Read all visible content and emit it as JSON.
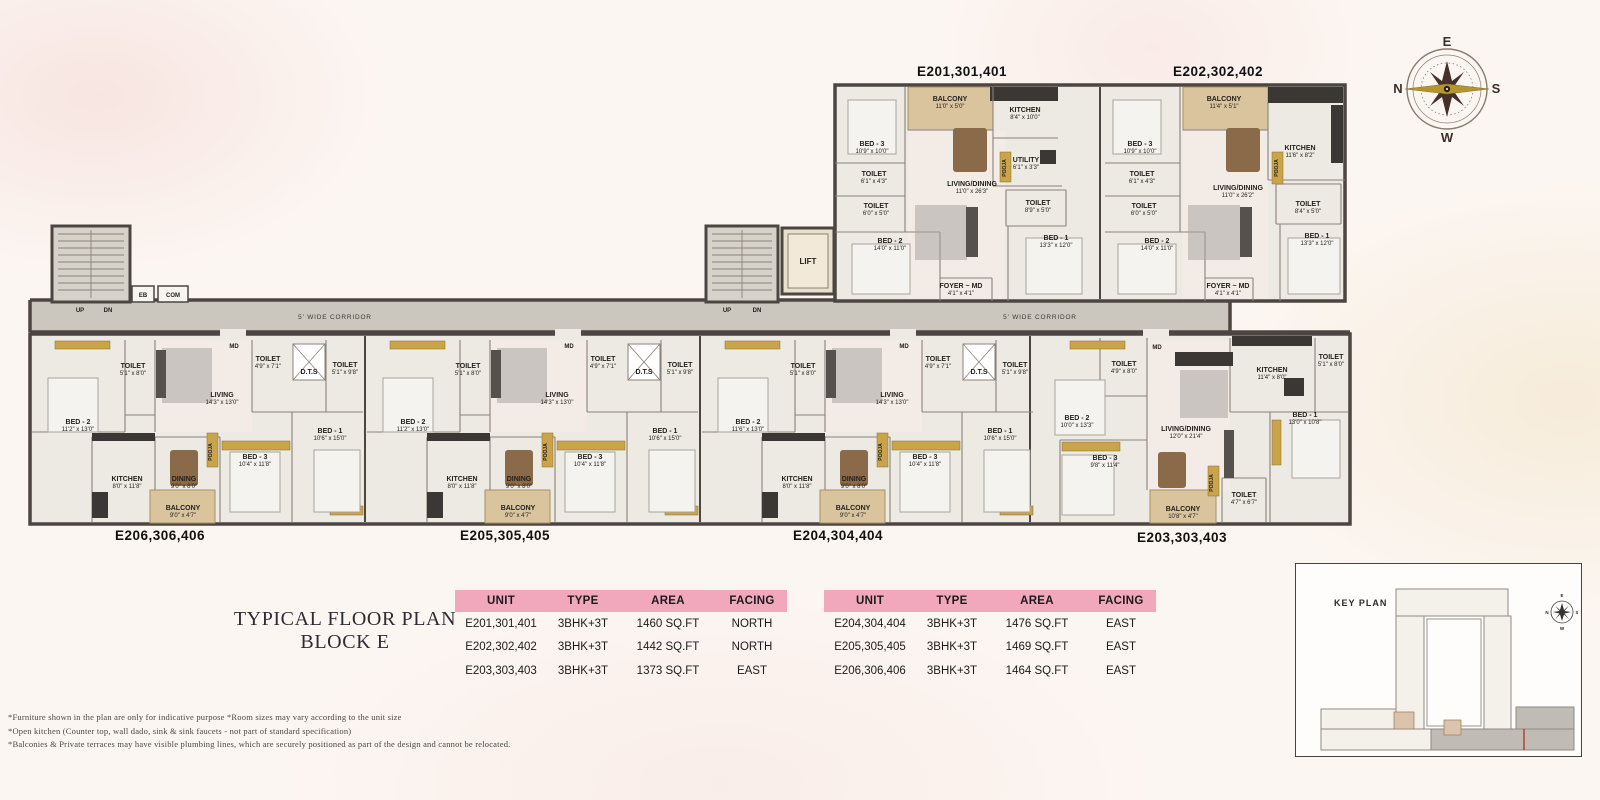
{
  "colors": {
    "header_pink": "#f2a8bc",
    "wall": "#4c4541",
    "partition": "#8a817a",
    "floor": "#edeae3",
    "living_tint": "#f3ece6",
    "balcony": "#d9c49e",
    "balcony_edge": "#a8925f",
    "corridor": "#cbc7be",
    "stair": "#d6d2c9",
    "dark_kitchen": "#3b3734",
    "gold": "#c9a44a",
    "bed": "#f4f3ef",
    "rug": "#a8a5a0"
  },
  "compass": {
    "top": "E",
    "right": "S",
    "bottom": "W",
    "left": "N"
  },
  "title": {
    "line1": "TYPICAL FLOOR PLAN",
    "line2": "BLOCK E"
  },
  "tables": [
    {
      "headers": [
        "UNIT",
        "TYPE",
        "AREA",
        "FACING"
      ],
      "rows": [
        [
          "E201,301,401",
          "3BHK+3T",
          "1460 SQ.FT",
          "NORTH"
        ],
        [
          "E202,302,402",
          "3BHK+3T",
          "1442 SQ.FT",
          "NORTH"
        ],
        [
          "E203,303,403",
          "3BHK+3T",
          "1373 SQ.FT",
          "EAST"
        ]
      ]
    },
    {
      "headers": [
        "UNIT",
        "TYPE",
        "AREA",
        "FACING"
      ],
      "rows": [
        [
          "E204,304,404",
          "3BHK+3T",
          "1476 SQ.FT",
          "EAST"
        ],
        [
          "E205,305,405",
          "3BHK+3T",
          "1469 SQ.FT",
          "EAST"
        ],
        [
          "E206,306,406",
          "3BHK+3T",
          "1464 SQ.FT",
          "EAST"
        ]
      ]
    }
  ],
  "footnotes": [
    "*Furniture shown in the plan are only for indicative purpose *Room sizes may vary according to the unit size",
    "*Open kitchen (Counter top, wall dado, sink & sink faucets - not part of standard  specification)",
    "*Balconies & Private terraces may have visible plumbing lines, which are securely positioned as part of the design and cannot  be  relocated."
  ],
  "keyplan": {
    "label": "KEY PLAN",
    "compass": {
      "top": "E",
      "right": "S",
      "bottom": "W",
      "left": "N"
    }
  },
  "plan": {
    "corridor_labels": [
      {
        "t": "5' WIDE CORRIDOR",
        "x": 335,
        "y": 319
      },
      {
        "t": "5' WIDE CORRIDOR",
        "x": 1040,
        "y": 319
      }
    ],
    "small_labels": [
      {
        "t": "UP",
        "x": 80,
        "y": 312
      },
      {
        "t": "DN",
        "x": 108,
        "y": 312
      },
      {
        "t": "UP",
        "x": 727,
        "y": 312
      },
      {
        "t": "DN",
        "x": 757,
        "y": 312
      },
      {
        "t": "EB",
        "x": 143,
        "y": 297
      },
      {
        "t": "COM",
        "x": 173,
        "y": 297
      },
      {
        "t": "LIFT",
        "x": 808,
        "y": 264,
        "s": 8
      },
      {
        "t": "MD",
        "x": 234,
        "y": 348
      },
      {
        "t": "MD",
        "x": 569,
        "y": 348
      },
      {
        "t": "MD",
        "x": 904,
        "y": 348
      },
      {
        "t": "MD",
        "x": 1157,
        "y": 349
      },
      {
        "t": "POOJA",
        "x": 212,
        "y": 452,
        "r": -90,
        "s": 5
      },
      {
        "t": "POOJA",
        "x": 547,
        "y": 452,
        "r": -90,
        "s": 5
      },
      {
        "t": "POOJA",
        "x": 882,
        "y": 452,
        "r": -90,
        "s": 5
      },
      {
        "t": "POOJA",
        "x": 1213,
        "y": 483,
        "r": -90,
        "s": 5
      },
      {
        "t": "POOJA",
        "x": 1006,
        "y": 168,
        "r": -90,
        "s": 5
      },
      {
        "t": "POOJA",
        "x": 1278,
        "y": 168,
        "r": -90,
        "s": 5
      }
    ],
    "units": [
      {
        "label": "E201,301,401",
        "lx": 962,
        "ly": 76,
        "rooms": [
          {
            "n": "BED - 3",
            "d": "10'9\" x 10'0\"",
            "x": 872,
            "y": 146
          },
          {
            "n": "BALCONY",
            "d": "11'0\" x 5'0\"",
            "x": 950,
            "y": 101
          },
          {
            "n": "KITCHEN",
            "d": "8'4\" x 10'0\"",
            "x": 1025,
            "y": 112
          },
          {
            "n": "UTILITY",
            "d": "6'1\" x 3'3\"",
            "x": 1026,
            "y": 162
          },
          {
            "n": "TOILET",
            "d": "6'1\" x 4'3\"",
            "x": 874,
            "y": 176
          },
          {
            "n": "TOILET",
            "d": "6'0\" x 5'0\"",
            "x": 876,
            "y": 208
          },
          {
            "n": "LIVING/DINING",
            "d": "11'0\" x 26'3\"",
            "x": 972,
            "y": 186
          },
          {
            "n": "TOILET",
            "d": "8'9\" x 5'0\"",
            "x": 1038,
            "y": 205
          },
          {
            "n": "BED - 2",
            "d": "14'0\" x 11'0\"",
            "x": 890,
            "y": 243
          },
          {
            "n": "BED - 1",
            "d": "13'3\" x 12'0\"",
            "x": 1056,
            "y": 240
          },
          {
            "n": "FOYER ~ MD",
            "d": "4'1\" x 4'1\"",
            "x": 961,
            "y": 288
          }
        ]
      },
      {
        "label": "E202,302,402",
        "lx": 1218,
        "ly": 76,
        "rooms": [
          {
            "n": "BED - 3",
            "d": "10'9\" x 10'0\"",
            "x": 1140,
            "y": 146
          },
          {
            "n": "BALCONY",
            "d": "11'4\" x 5'1\"",
            "x": 1224,
            "y": 101
          },
          {
            "n": "KITCHEN",
            "d": "11'6\" x 8'2\"",
            "x": 1300,
            "y": 150
          },
          {
            "n": "TOILET",
            "d": "6'1\" x 4'3\"",
            "x": 1142,
            "y": 176
          },
          {
            "n": "TOILET",
            "d": "6'0\" x 5'0\"",
            "x": 1144,
            "y": 208
          },
          {
            "n": "LIVING/DINING",
            "d": "11'0\" x 26'2\"",
            "x": 1238,
            "y": 190
          },
          {
            "n": "TOILET",
            "d": "8'4\" x 5'0\"",
            "x": 1308,
            "y": 206
          },
          {
            "n": "BED - 2",
            "d": "14'0\" x 11'0\"",
            "x": 1157,
            "y": 243
          },
          {
            "n": "BED - 1",
            "d": "13'3\" x 12'0\"",
            "x": 1317,
            "y": 238
          },
          {
            "n": "FOYER ~ MD",
            "d": "4'1\" x 4'1\"",
            "x": 1228,
            "y": 288
          }
        ]
      },
      {
        "label": "E206,306,406",
        "lx": 160,
        "ly": 540,
        "rooms": [
          {
            "n": "BED - 2",
            "d": "11'2\" x 13'0\"",
            "x": 78,
            "y": 424
          },
          {
            "n": "TOILET",
            "d": "5'1\" x 8'0\"",
            "x": 133,
            "y": 368
          },
          {
            "n": "LIVING",
            "d": "14'3\" x 13'0\"",
            "x": 222,
            "y": 397
          },
          {
            "n": "TOILET",
            "d": "4'9\" x 7'1\"",
            "x": 268,
            "y": 361
          },
          {
            "n": "D.T.S",
            "d": "",
            "x": 309,
            "y": 374
          },
          {
            "n": "TOILET",
            "d": "5'1\" x 9'8\"",
            "x": 345,
            "y": 367
          },
          {
            "n": "BED - 1",
            "d": "10'6\" x 15'0\"",
            "x": 330,
            "y": 433
          },
          {
            "n": "BED - 3",
            "d": "10'4\" x 11'8\"",
            "x": 255,
            "y": 459
          },
          {
            "n": "KITCHEN",
            "d": "8'0\" x 11'8\"",
            "x": 127,
            "y": 481
          },
          {
            "n": "DINING",
            "d": "9'0\" x 8'0\"",
            "x": 184,
            "y": 481
          },
          {
            "n": "BALCONY",
            "d": "9'0\" x 4'7\"",
            "x": 183,
            "y": 510
          }
        ]
      },
      {
        "label": "E205,305,405",
        "lx": 505,
        "ly": 540,
        "rooms": [
          {
            "n": "BED - 2",
            "d": "11'2\" x 13'0\"",
            "x": 413,
            "y": 424
          },
          {
            "n": "TOILET",
            "d": "5'1\" x 8'0\"",
            "x": 468,
            "y": 368
          },
          {
            "n": "LIVING",
            "d": "14'3\" x 13'0\"",
            "x": 557,
            "y": 397
          },
          {
            "n": "TOILET",
            "d": "4'9\" x 7'1\"",
            "x": 603,
            "y": 361
          },
          {
            "n": "D.T.S",
            "d": "",
            "x": 644,
            "y": 374
          },
          {
            "n": "TOILET",
            "d": "5'1\" x 9'8\"",
            "x": 680,
            "y": 367
          },
          {
            "n": "BED - 1",
            "d": "10'6\" x 15'0\"",
            "x": 665,
            "y": 433
          },
          {
            "n": "BED - 3",
            "d": "10'4\" x 11'8\"",
            "x": 590,
            "y": 459
          },
          {
            "n": "KITCHEN",
            "d": "8'0\" x 11'8\"",
            "x": 462,
            "y": 481
          },
          {
            "n": "DINING",
            "d": "9'0\" x 8'0\"",
            "x": 519,
            "y": 481
          },
          {
            "n": "BALCONY",
            "d": "9'0\" x 4'7\"",
            "x": 518,
            "y": 510
          }
        ]
      },
      {
        "label": "E204,304,404",
        "lx": 838,
        "ly": 540,
        "rooms": [
          {
            "n": "BED - 2",
            "d": "11'6\" x 13'0\"",
            "x": 748,
            "y": 424
          },
          {
            "n": "TOILET",
            "d": "5'1\" x 8'0\"",
            "x": 803,
            "y": 368
          },
          {
            "n": "LIVING",
            "d": "14'3\" x 13'0\"",
            "x": 892,
            "y": 397
          },
          {
            "n": "TOILET",
            "d": "4'9\" x 7'1\"",
            "x": 938,
            "y": 361
          },
          {
            "n": "D.T.S",
            "d": "",
            "x": 979,
            "y": 374
          },
          {
            "n": "TOILET",
            "d": "5'1\" x 9'8\"",
            "x": 1015,
            "y": 367
          },
          {
            "n": "BED - 1",
            "d": "10'6\" x 15'0\"",
            "x": 1000,
            "y": 433
          },
          {
            "n": "BED - 3",
            "d": "10'4\" x 11'8\"",
            "x": 925,
            "y": 459
          },
          {
            "n": "KITCHEN",
            "d": "8'0\" x 11'8\"",
            "x": 797,
            "y": 481
          },
          {
            "n": "DINING",
            "d": "9'0\" x 8'0\"",
            "x": 854,
            "y": 481
          },
          {
            "n": "BALCONY",
            "d": "9'0\" x 4'7\"",
            "x": 853,
            "y": 510
          }
        ]
      },
      {
        "label": "E203,303,403",
        "lx": 1182,
        "ly": 542,
        "rooms": [
          {
            "n": "TOILET",
            "d": "4'9\" x 8'0\"",
            "x": 1124,
            "y": 366
          },
          {
            "n": "BED - 2",
            "d": "10'0\" x 13'3\"",
            "x": 1077,
            "y": 420
          },
          {
            "n": "KITCHEN",
            "d": "11'4\" x 8'0\"",
            "x": 1272,
            "y": 372
          },
          {
            "n": "TOILET",
            "d": "5'1\" x 8'0\"",
            "x": 1331,
            "y": 359
          },
          {
            "n": "LIVING/DINING",
            "d": "12'0\" x 21'4\"",
            "x": 1186,
            "y": 431
          },
          {
            "n": "BED - 1",
            "d": "13'0\" x 10'8\"",
            "x": 1305,
            "y": 417
          },
          {
            "n": "BED - 3",
            "d": "9'8\" x 11'4\"",
            "x": 1105,
            "y": 460
          },
          {
            "n": "TOILET",
            "d": "4'7\" x 6'7\"",
            "x": 1244,
            "y": 497
          },
          {
            "n": "BALCONY",
            "d": "10'8\" x 4'7\"",
            "x": 1183,
            "y": 511
          }
        ]
      }
    ]
  }
}
